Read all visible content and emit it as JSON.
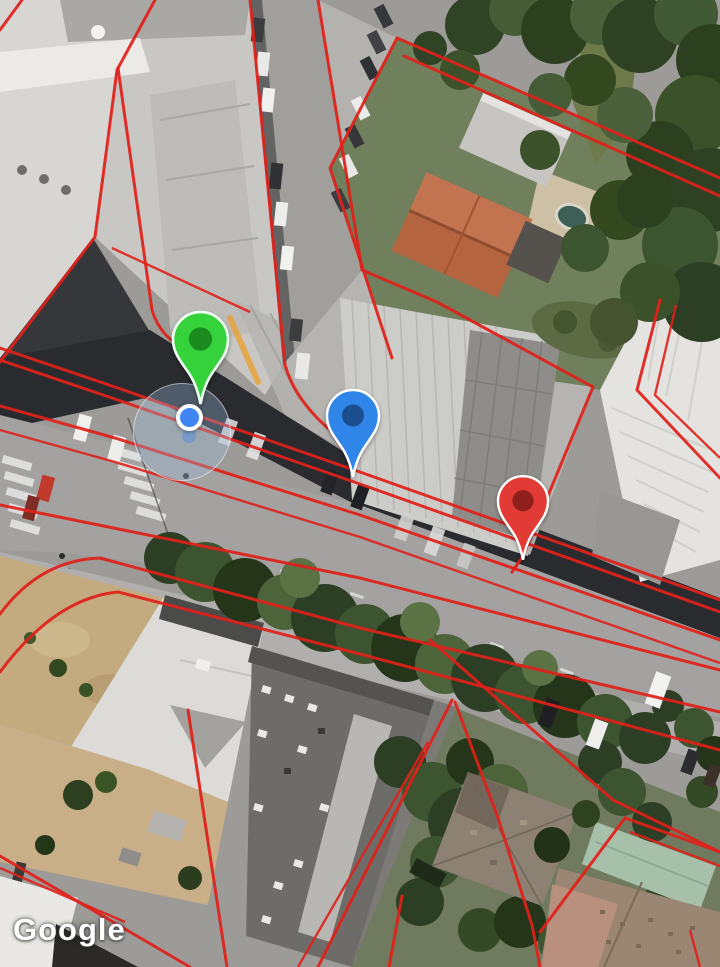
{
  "attribution": {
    "label": "Google",
    "icon": "google-logo"
  },
  "colors": {
    "boundary-red": "#e0201a",
    "curb-orange": "#e8a23c",
    "pin-green": "#35d23c",
    "pin-green-inner": "#1b8a1f",
    "pin-blue": "#2f86e8",
    "pin-blue-inner": "#1b4e8e",
    "pin-red": "#e23a34",
    "pin-red-inner": "#8f1f1b",
    "dot-blue": "#3f86f2"
  },
  "map": {
    "type": "satellite",
    "overlay": "red cadastral parcel boundaries",
    "markers": [
      {
        "id": "green",
        "name": "map-pin-green",
        "x": 200,
        "y": 404,
        "w": 55,
        "h": 92,
        "body": "#35d23c",
        "inner": "#1b8a1f",
        "outline": "#eafff0"
      },
      {
        "id": "blue",
        "name": "map-pin-blue",
        "x": 353,
        "y": 477,
        "w": 52,
        "h": 87,
        "body": "#2f86e8",
        "inner": "#1b4e8e",
        "outline": "#ffffff"
      },
      {
        "id": "red",
        "name": "map-pin-red",
        "x": 523,
        "y": 560,
        "w": 50,
        "h": 84,
        "body": "#e23a34",
        "inner": "#8f1f1b",
        "outline": "#ffffff"
      }
    ],
    "my_location": {
      "x": 189,
      "y": 417,
      "dot_radius": 9.5,
      "accuracy_center_x": 181,
      "accuracy_center_y": 431,
      "accuracy_radius": 48
    }
  }
}
